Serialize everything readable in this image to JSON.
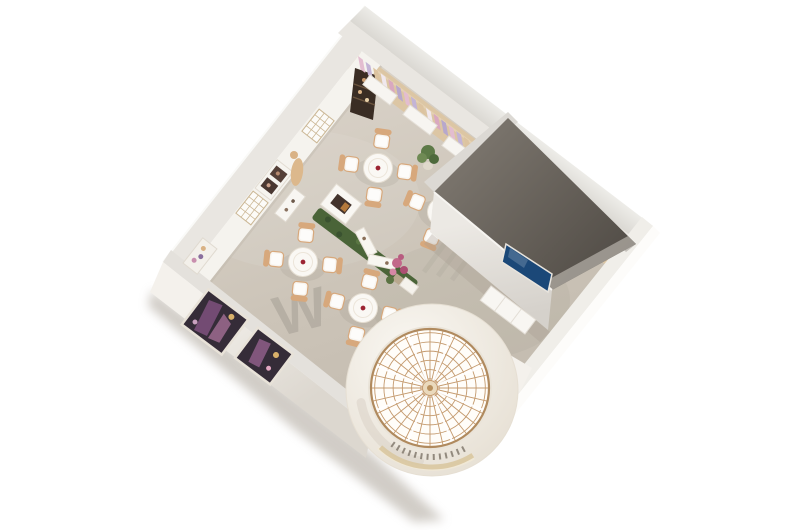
{
  "scene": {
    "title": "aerial-3d-floorplan-render",
    "view": "top-down oblique cutaway of a showroom interior",
    "background": "#ffffff"
  },
  "watermark": {
    "text": "W"
  },
  "palette": {
    "background": "#ffffff",
    "floor": "#cdc5ba",
    "floor_light": "#d9d2c8",
    "wall_top": "#e8e5e0",
    "wall_inner_face": "#f5f3ee",
    "wood_strip": "#dcc6a4",
    "private_room_floor": "#68635c",
    "screen_blue": "#1b4878",
    "dome_frame": "#c49a6e",
    "rotunda_wall": "#f2eee7",
    "gold_trim": "#d9c7a0",
    "hedge_green": "#4a6438",
    "flower_pink": "#c2688a",
    "chair_trim": "#d7a87c",
    "table_top": "#faf8f4",
    "table_accent": "#9c2433",
    "ground_shadow": "#b3aca2",
    "display_dark": "#352c38",
    "product_purple": "#7a4f7a",
    "cabinet_dark": "#3a2d24",
    "plant_green": "#5d7a47",
    "watermark_grey": "#a29c92"
  },
  "furniture": {
    "tables": [
      {
        "x": 378,
        "y": 168,
        "rot": 8
      },
      {
        "x": 442,
        "y": 212,
        "rot": 22
      },
      {
        "x": 303,
        "y": 262,
        "rot": 6
      },
      {
        "x": 363,
        "y": 308,
        "rot": 14
      }
    ],
    "chairs_per_table": 4
  },
  "dome": {
    "cx": 432,
    "cy": 390,
    "outer_r": 86,
    "glass_cx": 430,
    "glass_cy": 388,
    "glass_r": 59,
    "spokes": 28,
    "rings": 6,
    "white_mullions": 8,
    "balcony_dashes": 13
  },
  "shelving": {
    "count": 19,
    "step": 9.5,
    "colors": [
      "#e3bdd0",
      "#c3b4d6",
      "#dcc3a0",
      "#f0e8ee",
      "#d9a8c0",
      "#b7a8cc"
    ]
  }
}
